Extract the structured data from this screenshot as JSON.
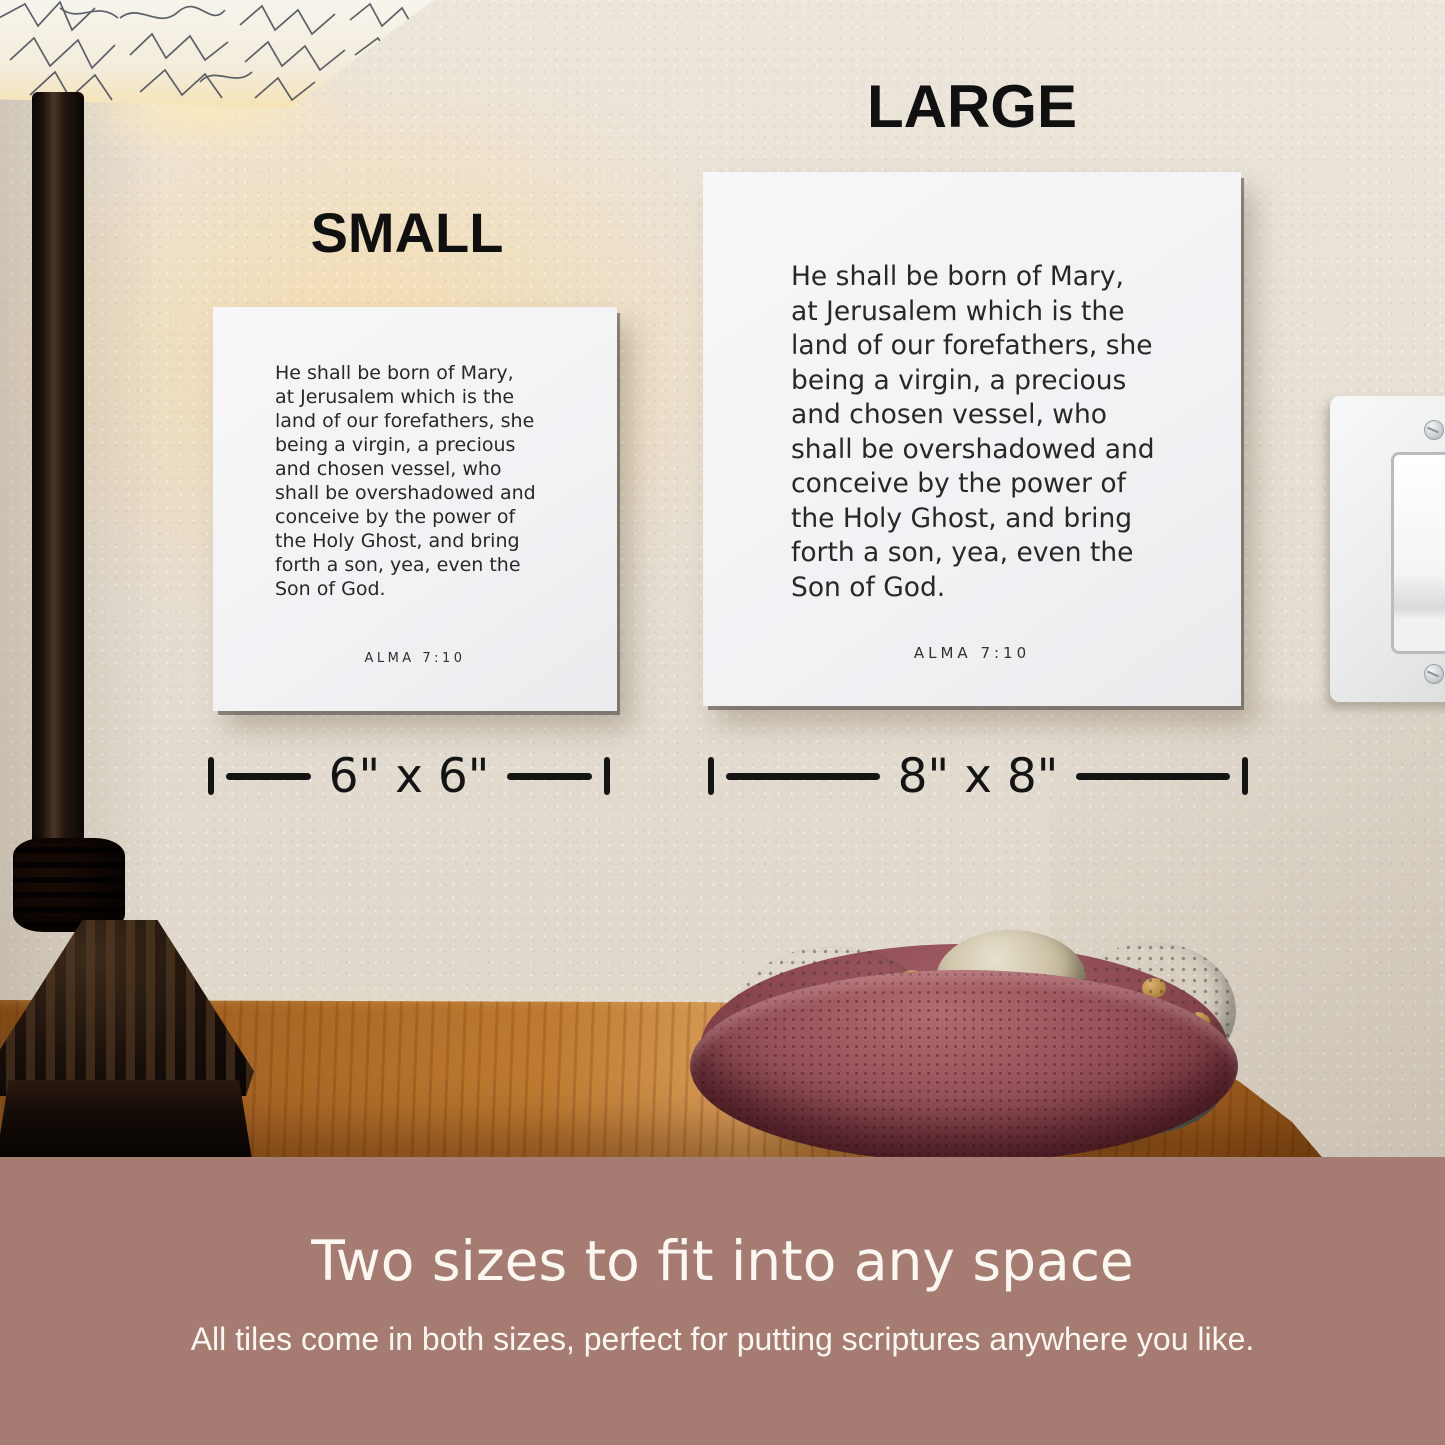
{
  "size_labels": {
    "small": "SMALL",
    "large": "LARGE"
  },
  "tile": {
    "scripture": "He shall be born of Mary,\nat Jerusalem which is the\nland of our forefathers, she\nbeing a virgin, a precious\nand chosen vessel, who\nshall be overshadowed and\nconceive by the power of\nthe Holy Ghost, and bring\nforth a son, yea, even the\nSon of God.",
    "reference": "ALMA 7:10"
  },
  "dimension_labels": {
    "small": "6\" x 6\"",
    "large": "8\" x 8\""
  },
  "footer": {
    "title": "Two sizes to fit into any space",
    "subtitle": "All tiles come in both sizes, perfect for putting scriptures anywhere you like."
  },
  "colors": {
    "banner": "#a67c72",
    "wall": "#e9e2d6",
    "tile_background": "#f5f5f7",
    "tile_text": "#282828",
    "wood_table": "#b06a24",
    "bowl": "#97535b",
    "label_text": "#101010",
    "footer_text": "#fbf7f1"
  }
}
